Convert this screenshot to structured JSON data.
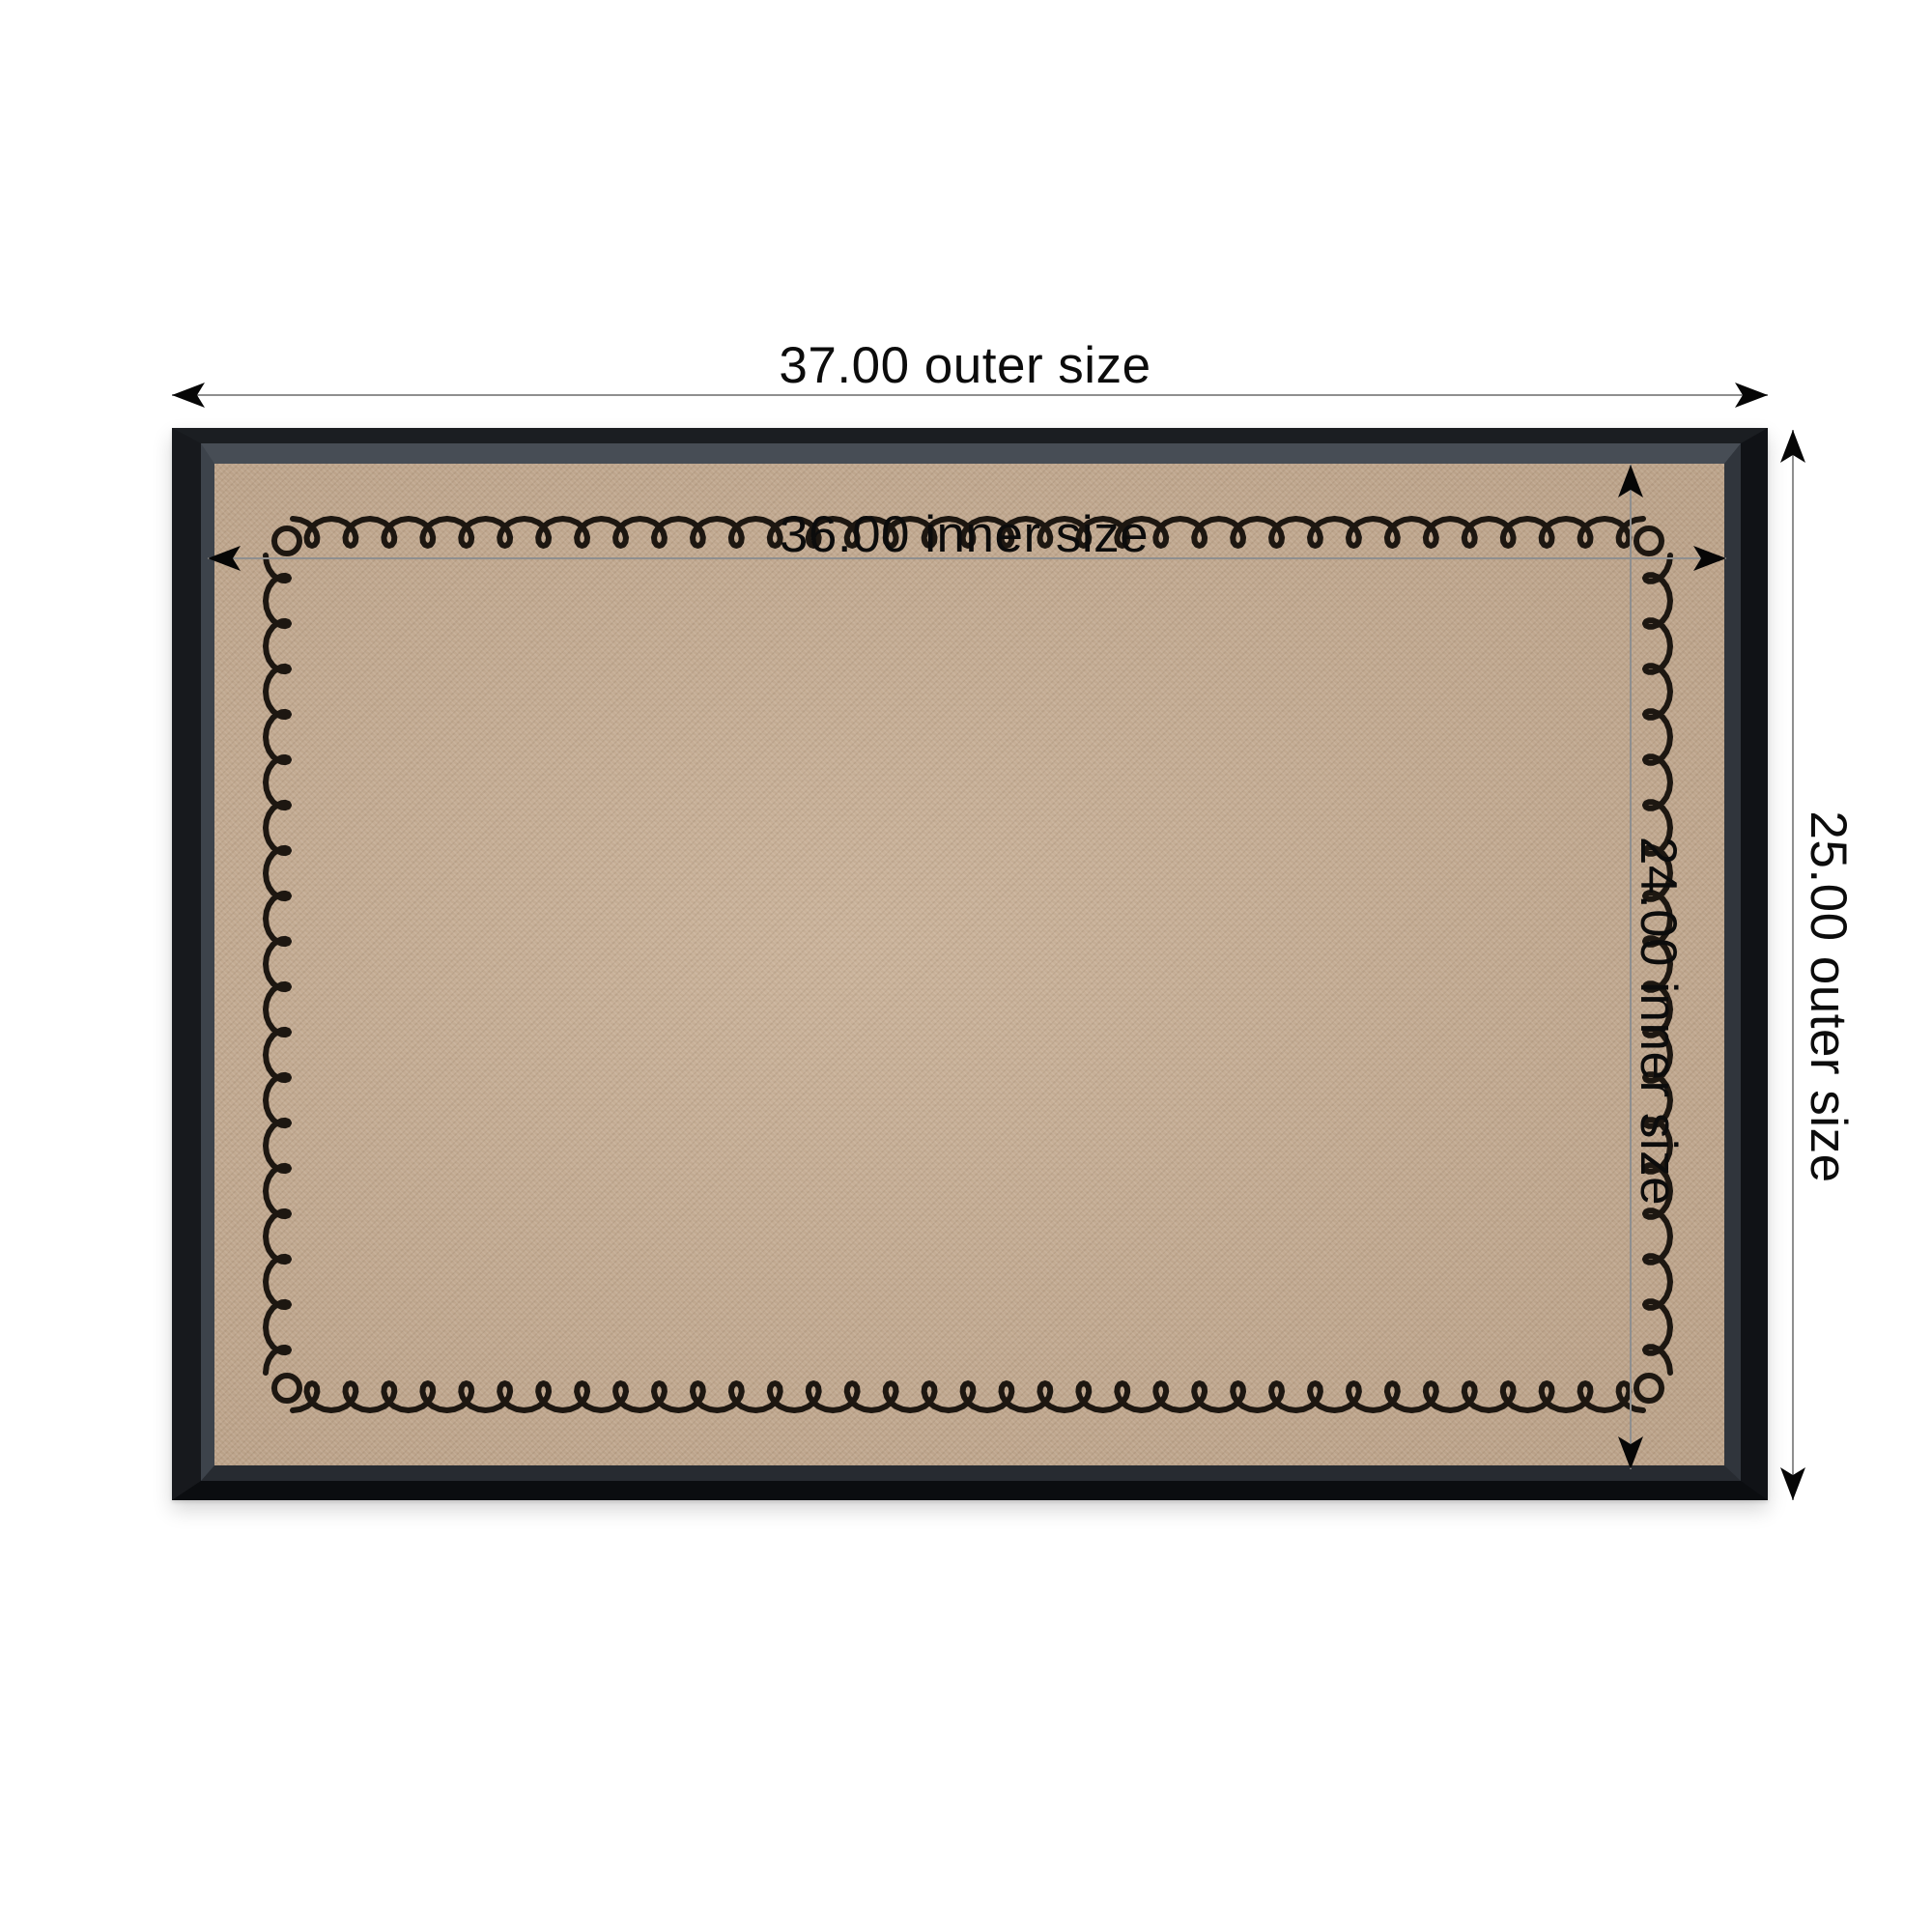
{
  "diagram": {
    "labels": {
      "outer_width": "37.00 outer size",
      "outer_height": "25.00 outer size",
      "inner_width": "36.00 inner size",
      "inner_height": "24.00 inner size"
    },
    "values": {
      "outer_width": 37.0,
      "outer_height": 25.0,
      "inner_width": 36.0,
      "inner_height": 24.0
    },
    "colors": {
      "background": "#ffffff",
      "frame": "#111317",
      "frame_bevel": "#3c424a",
      "board_surface": "#c4ab92",
      "stitch_border": "#1d1711",
      "dimension_line": "#8f8f8f",
      "arrowhead": "#060606",
      "label_text": "#0c0c0c"
    }
  }
}
